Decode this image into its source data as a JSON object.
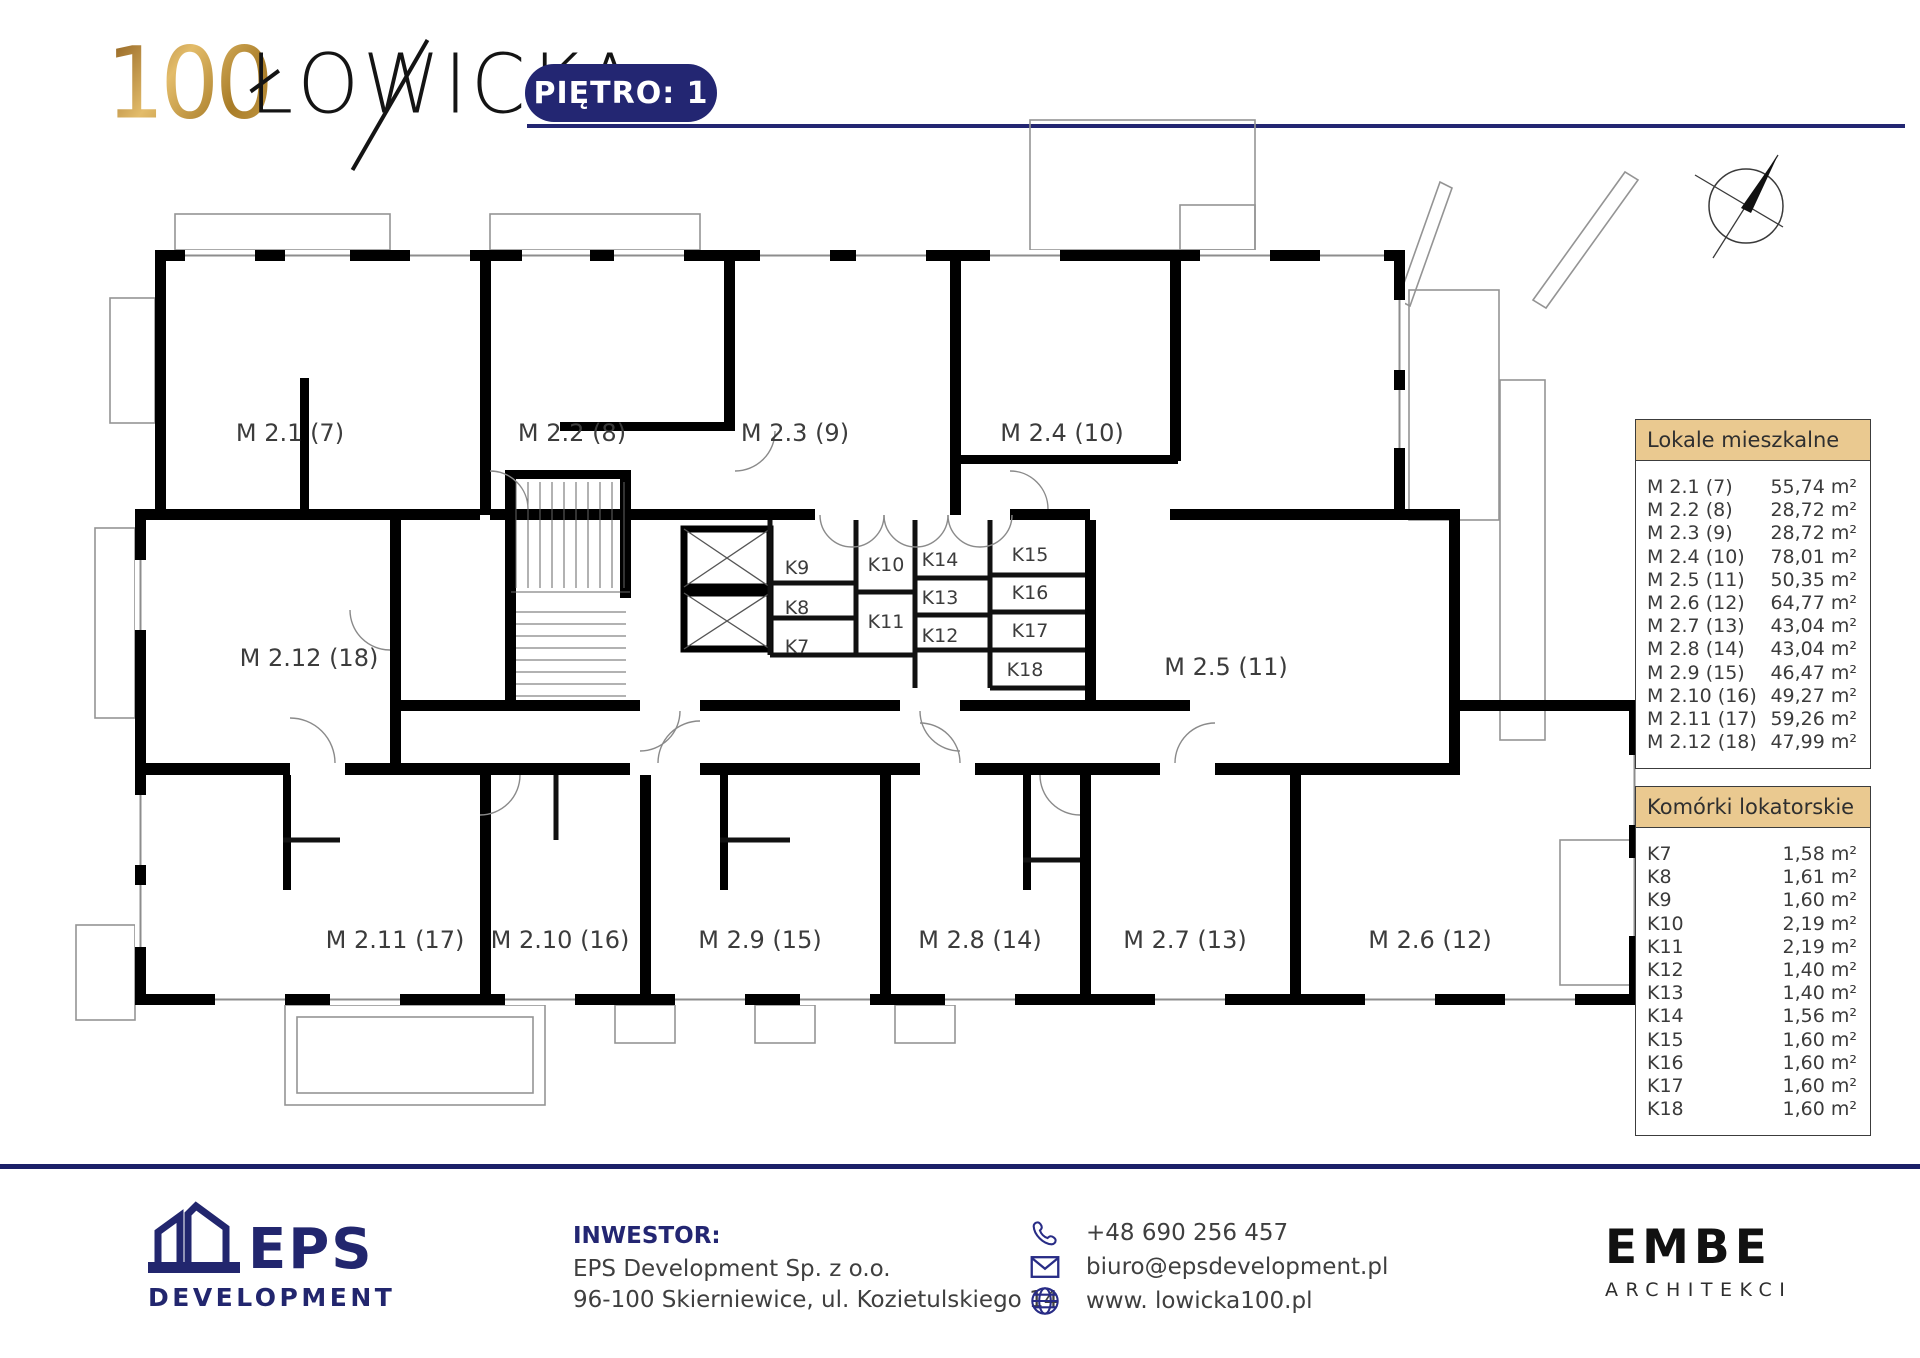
{
  "header": {
    "logo_number": "100",
    "logo_text": "ŁOWICKA",
    "floor_badge": "PIĘTRO: 1"
  },
  "legend": {
    "apartments": {
      "title": "Lokale mieszkalne",
      "items": [
        {
          "id": "M 2.1 (7)",
          "area": "55,74 m²"
        },
        {
          "id": "M 2.2 (8)",
          "area": "28,72 m²"
        },
        {
          "id": "M 2.3 (9)",
          "area": "28,72 m²"
        },
        {
          "id": "M 2.4 (10)",
          "area": "78,01 m²"
        },
        {
          "id": "M 2.5 (11)",
          "area": "50,35 m²"
        },
        {
          "id": "M 2.6 (12)",
          "area": "64,77 m²"
        },
        {
          "id": "M 2.7 (13)",
          "area": "43,04 m²"
        },
        {
          "id": "M 2.8 (14)",
          "area": "43,04 m²"
        },
        {
          "id": "M 2.9 (15)",
          "area": "46,47 m²"
        },
        {
          "id": "M 2.10 (16)",
          "area": "49,27 m²"
        },
        {
          "id": "M 2.11 (17)",
          "area": "59,26 m²"
        },
        {
          "id": "M 2.12 (18)",
          "area": "47,99 m²"
        }
      ]
    },
    "storage": {
      "title": "Komórki lokatorskie",
      "items": [
        {
          "id": "K7",
          "area": "1,58 m²"
        },
        {
          "id": "K8",
          "area": "1,61 m²"
        },
        {
          "id": "K9",
          "area": "1,60 m²"
        },
        {
          "id": "K10",
          "area": "2,19 m²"
        },
        {
          "id": "K11",
          "area": "2,19 m²"
        },
        {
          "id": "K12",
          "area": "1,40 m²"
        },
        {
          "id": "K13",
          "area": "1,40 m²"
        },
        {
          "id": "K14",
          "area": "1,56 m²"
        },
        {
          "id": "K15",
          "area": "1,60 m²"
        },
        {
          "id": "K16",
          "area": "1,60 m²"
        },
        {
          "id": "K17",
          "area": "1,60 m²"
        },
        {
          "id": "K18",
          "area": "1,60 m²"
        }
      ]
    }
  },
  "plan": {
    "apartment_labels": [
      {
        "label": "M 2.1 (7)",
        "x": 290,
        "y": 433
      },
      {
        "label": "M 2.2 (8)",
        "x": 572,
        "y": 433
      },
      {
        "label": "M 2.3 (9)",
        "x": 795,
        "y": 433
      },
      {
        "label": "M 2.4 (10)",
        "x": 1062,
        "y": 433
      },
      {
        "label": "M 2.12 (18)",
        "x": 309,
        "y": 658
      },
      {
        "label": "M 2.5 (11)",
        "x": 1226,
        "y": 667
      },
      {
        "label": "M 2.11 (17)",
        "x": 395,
        "y": 940
      },
      {
        "label": "M 2.10 (16)",
        "x": 560,
        "y": 940
      },
      {
        "label": "M 2.9 (15)",
        "x": 760,
        "y": 940
      },
      {
        "label": "M 2.8 (14)",
        "x": 980,
        "y": 940
      },
      {
        "label": "M 2.7 (13)",
        "x": 1185,
        "y": 940
      },
      {
        "label": "M 2.6 (12)",
        "x": 1430,
        "y": 940
      }
    ],
    "storage_labels": [
      {
        "label": "K9",
        "x": 797,
        "y": 568
      },
      {
        "label": "K8",
        "x": 797,
        "y": 608
      },
      {
        "label": "K7",
        "x": 797,
        "y": 647
      },
      {
        "label": "K10",
        "x": 886,
        "y": 565
      },
      {
        "label": "K11",
        "x": 886,
        "y": 622
      },
      {
        "label": "K14",
        "x": 940,
        "y": 560
      },
      {
        "label": "K13",
        "x": 940,
        "y": 598
      },
      {
        "label": "K12",
        "x": 940,
        "y": 636
      },
      {
        "label": "K15",
        "x": 1030,
        "y": 555
      },
      {
        "label": "K16",
        "x": 1030,
        "y": 593
      },
      {
        "label": "K17",
        "x": 1030,
        "y": 631
      },
      {
        "label": "K18",
        "x": 1025,
        "y": 670
      }
    ]
  },
  "footer": {
    "inwestor_label": "INWESTOR:",
    "company": "EPS Development Sp. z o.o.",
    "address": "96-100 Skierniewice, ul. Kozietulskiego 14",
    "contacts": {
      "phone": "+48 690 256 457",
      "email": "biuro@epsdevelopment.pl",
      "website": "www. lowicka100.pl"
    },
    "eps_logo": {
      "name": "EPS",
      "sub": "DEVELOPMENT"
    },
    "embe_logo": {
      "name": "EMBE",
      "sub": "ARCHITEKCI"
    }
  },
  "colors": {
    "navy": "#232672",
    "footer_navy": "#1b2068",
    "legend_gold": "#eac990",
    "wall_black": "#000000",
    "text_gray": "#3b3b3b",
    "logo_gold": "#b98b33"
  }
}
